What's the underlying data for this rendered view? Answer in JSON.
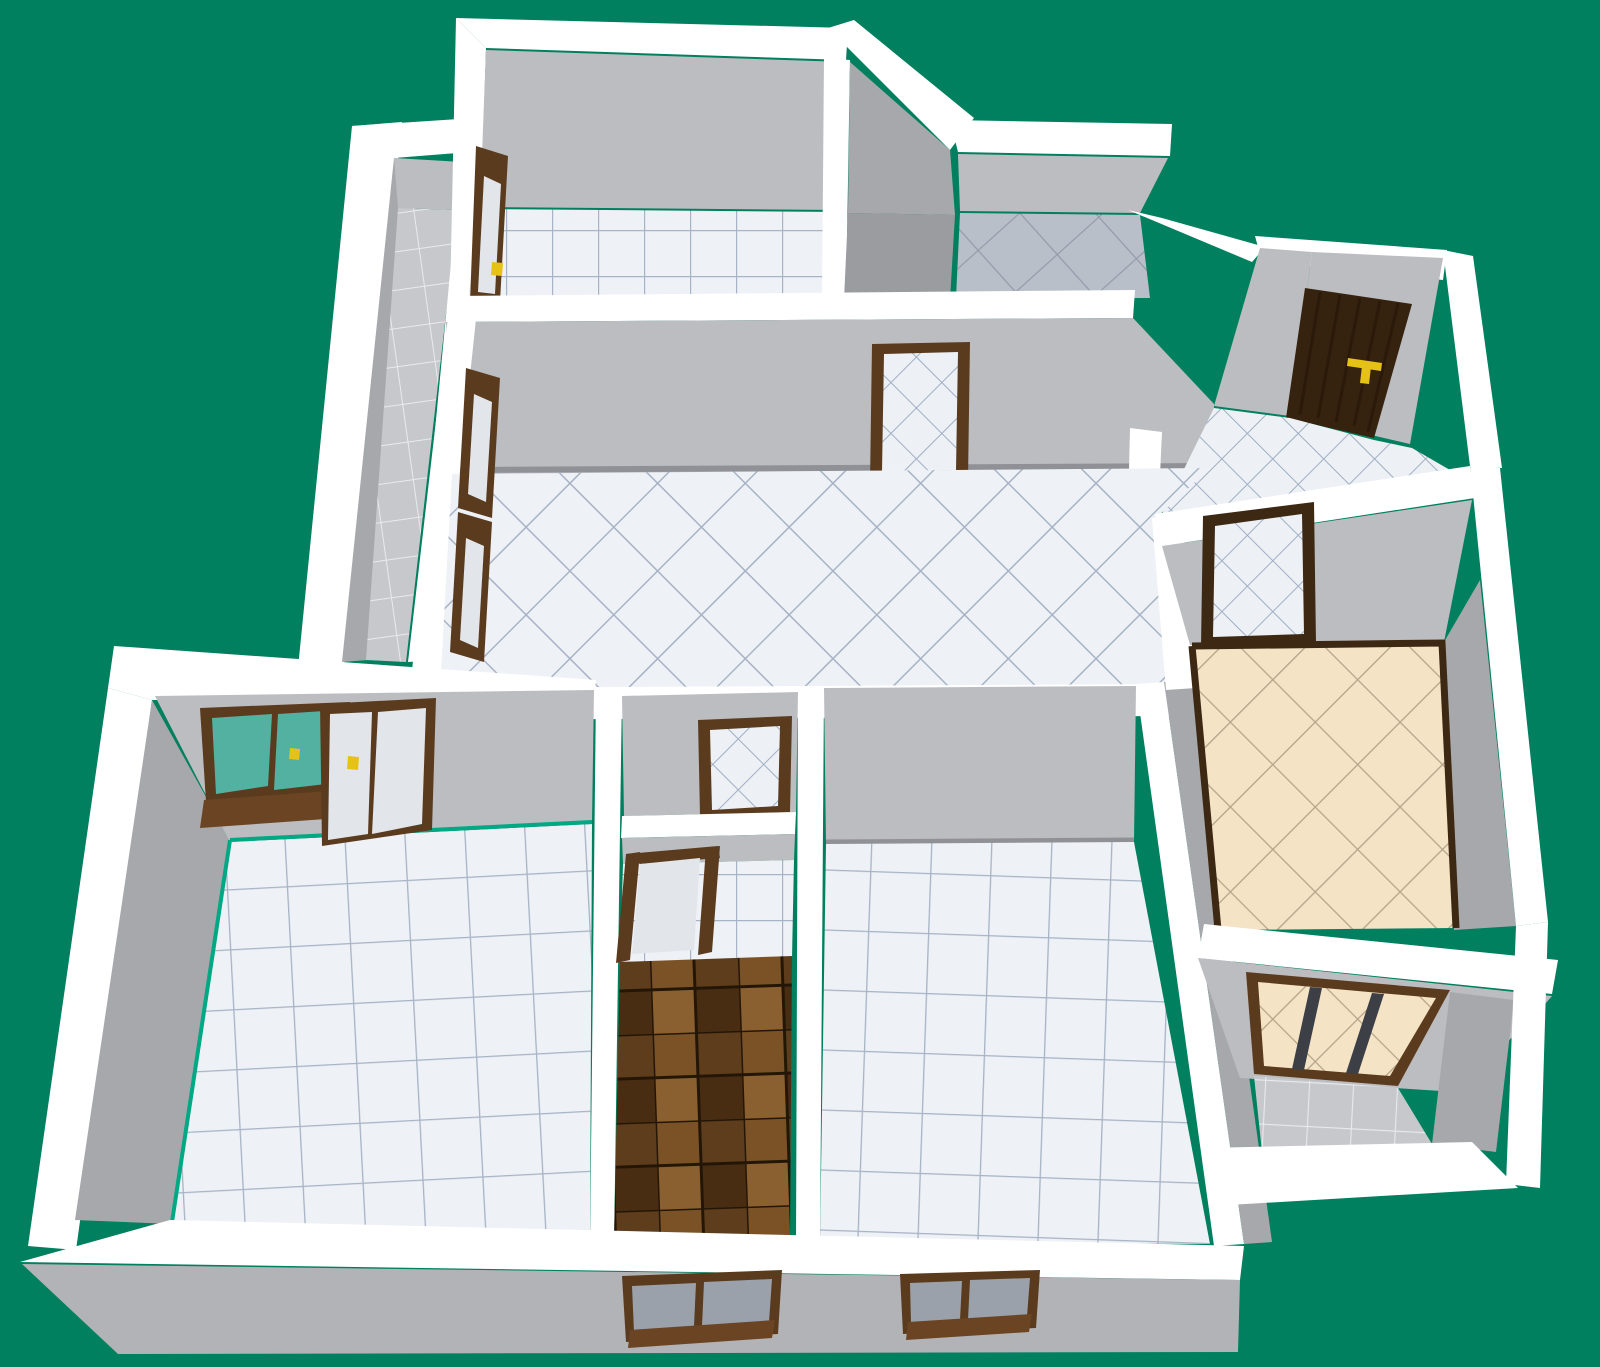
{
  "app": {
    "view_label": "3D floor plan render"
  },
  "colors": {
    "background": "#00805e",
    "wall_white": "#ffffff",
    "wall_light": "#bcbdc0",
    "wall_mid": "#a7a8ab",
    "wall_dark": "#9b9c9f",
    "wall_exterior": "#b2b3b6",
    "baseboard": "#8f9196",
    "tile_white_fill": "#eef1f5",
    "tile_white_grout": "#a7b3c6",
    "tile_entry_fill": "#edf0f4",
    "tile_entry_grout": "#9fafc4",
    "tile_bath_fill": "#b9bfc9",
    "tile_bath_grout": "#949baa",
    "tile_balcony_fill": "#c6c8cc",
    "tile_balcony_grout": "#e9eaec",
    "tile_beige_fill": "#f4e3c5",
    "tile_beige_grout": "#b4a58a",
    "tile_brown_a": "#7a5226",
    "tile_brown_b": "#5d3d1c",
    "tile_brown_c": "#8a6030",
    "tile_brown_d": "#482d13",
    "door_frame": "#5b3b1e",
    "door_frame_dark": "#3d2814",
    "entry_door": "#35220f",
    "door_grain": "#241607",
    "handle_gold": "#e6c217",
    "glass_teal": "#53b1a1",
    "glass_pale": "#e2e6ea",
    "glass_gray": "#9aa1ab",
    "window_mullion": "#3c3f45",
    "window_sill": "#6b4423",
    "accent_teal_line": "#00a884"
  },
  "scene": {
    "type": "isometric apartment floor plan",
    "rooms": [
      {
        "id": "balcony-left",
        "floor": "gray tiles"
      },
      {
        "id": "bedroom-top",
        "floor": "white square tiles"
      },
      {
        "id": "wc-top",
        "floor": "white diagonal tiles"
      },
      {
        "id": "bathroom-top-right",
        "floor": "blue-gray diagonal tiles"
      },
      {
        "id": "entry-hall",
        "floor": "white diagonal tiles"
      },
      {
        "id": "living-room",
        "floor": "white diagonal tiles"
      },
      {
        "id": "kitchen",
        "floor": "beige diagonal tiles"
      },
      {
        "id": "bathroom-center",
        "floor": "white diagonal tiles"
      },
      {
        "id": "hallway",
        "floor": "brown checker tiles"
      },
      {
        "id": "bedroom-left",
        "floor": "white square tiles"
      },
      {
        "id": "bedroom-right",
        "floor": "white square tiles"
      },
      {
        "id": "balcony-bottom-right",
        "floor": "gray tiles"
      }
    ],
    "door_count": 8,
    "window_count": 5
  }
}
